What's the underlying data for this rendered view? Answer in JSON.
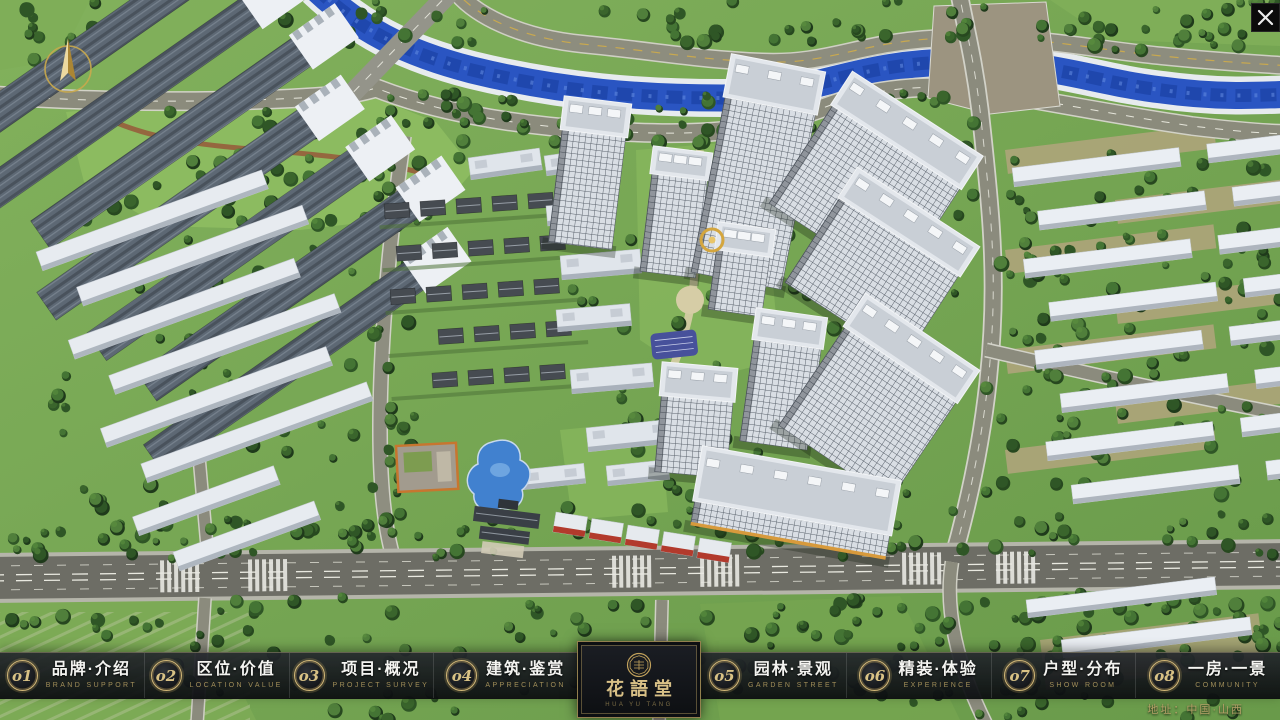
{
  "brand": {
    "name": "花語堂",
    "subtitle": "HUA YU TANG"
  },
  "window": {
    "close_label": "✕"
  },
  "nav": {
    "items": [
      {
        "num": "o1",
        "label": "品牌·介绍",
        "sub": "BRAND SUPPORT"
      },
      {
        "num": "o2",
        "label": "区位·价值",
        "sub": "LOCATION VALUE"
      },
      {
        "num": "o3",
        "label": "项目·概况",
        "sub": "PROJECT SURVEY"
      },
      {
        "num": "o4",
        "label": "建筑·鉴赏",
        "sub": "APPRECIATION"
      },
      {
        "num": "o5",
        "label": "园林·景观",
        "sub": "GARDEN STREET"
      },
      {
        "num": "o6",
        "label": "精装·体验",
        "sub": "EXPERIENCE"
      },
      {
        "num": "o7",
        "label": "户型·分布",
        "sub": "SHOW ROOM"
      },
      {
        "num": "o8",
        "label": "一房·一景",
        "sub": "COMMUNITY"
      }
    ]
  },
  "footer": {
    "address": "地址：中国·山西"
  },
  "colors": {
    "accent_gold": "#c9ab66",
    "nav_label": "#f4f4f1",
    "nav_sub": "#a18e59",
    "bar_background": "rgba(16,18,22,0.9)",
    "river_blue": "#2a55c2"
  }
}
